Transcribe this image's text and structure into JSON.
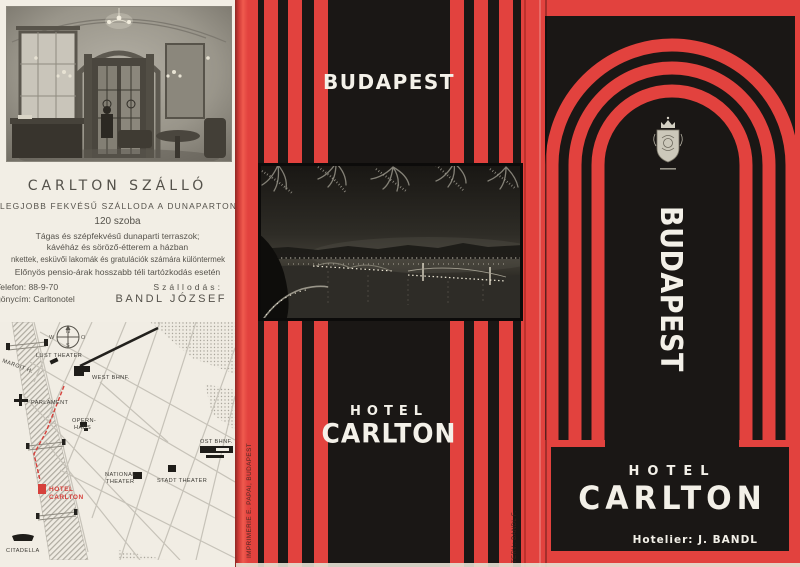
{
  "colors": {
    "red": "#e2423e",
    "black": "#1a1715",
    "cream": "#f2eee5",
    "label_red": "#d6413c"
  },
  "left_panel": {
    "title": "CARLTON SZÁLLÓ",
    "subtitle": "LEGJOBB FEKVÉSŰ SZÁLLODA A DUNAPARTON",
    "rooms": "120 szoba",
    "body_lines": [
      "Tágas és szépfekvésű dunaparti terraszok;",
      "kávéház és söröző-étterem a házban",
      "nkettek, esküvői lakomák és gratulációk számára különtermek",
      "Előnyös pensio-árak hosszabb téli tartózkodás esetén"
    ],
    "phone": "Telefon: 88-9-70",
    "telegram": "gönycím: Carltonotel",
    "manager_label": "Szállodás:",
    "manager_name": "BANDL JÓZSEF",
    "map": {
      "compass": {
        "n": "N",
        "o": "O",
        "s": "S",
        "w": "W"
      },
      "labels": [
        {
          "t": "MARGIT H."
        },
        {
          "t": "LUST THEATER"
        },
        {
          "t": "WEST BHNF."
        },
        {
          "t": "PARLAMENT"
        },
        {
          "t": "OPERN-"
        },
        {
          "t": "HAUS"
        },
        {
          "t": "OST BHNF."
        },
        {
          "t": "NATIONAL"
        },
        {
          "t": "THEATER"
        },
        {
          "t": "STADT THEATER"
        },
        {
          "t": "HOTEL"
        },
        {
          "t": "CARLTON"
        },
        {
          "t": "CITADELLA"
        }
      ]
    }
  },
  "middle_panel": {
    "city": "BUDAPEST",
    "hotel_word": "HOTEL",
    "hotel_name": "CARLTON",
    "printer_credit": "IMPRIMERIE E. PAPAI, BUDAPEST",
    "design_credit": "TERV.: BANDL F."
  },
  "right_panel": {
    "city_vertical": "BUDAPEST",
    "hotel_word": "HOTEL",
    "hotel_name": "CARLTON",
    "hotelier": "Hotelier: J. BANDL"
  }
}
